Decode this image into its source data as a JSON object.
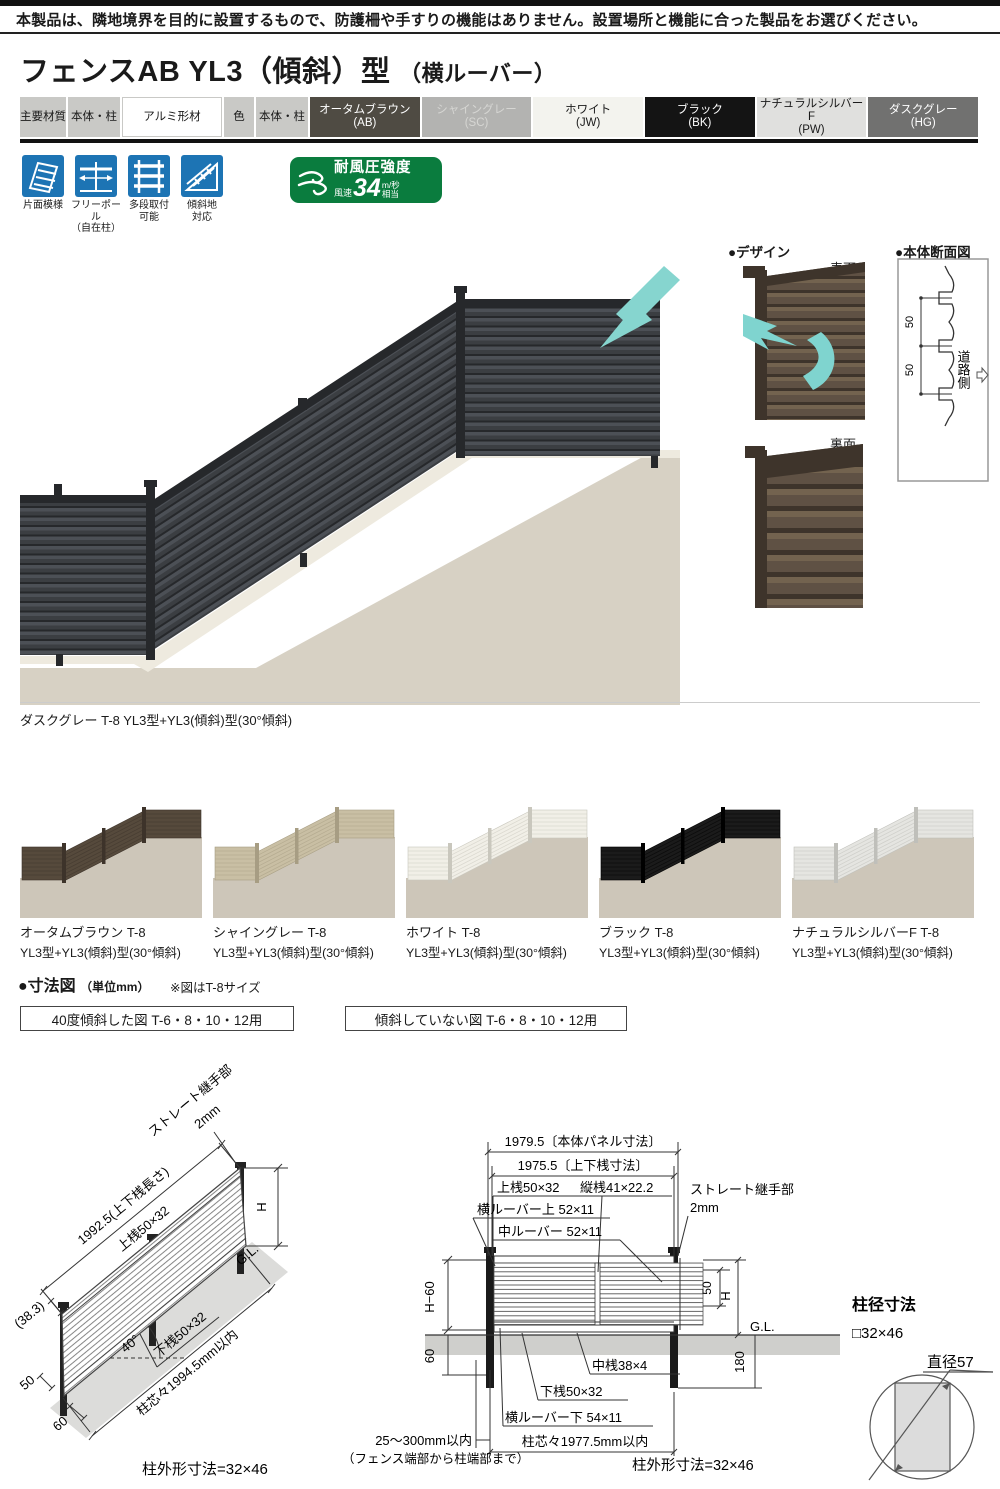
{
  "notice": "本製品は、隣地境界を目的に設置するもので、防護柵や手すりの機能はありません。設置場所と機能に合った製品をお選びください。",
  "title": {
    "main": "フェンスAB YL3（傾斜）型",
    "sub": "（横ルーバー）"
  },
  "spec": {
    "material_header": "主要材質",
    "material_scope": "本体・柱",
    "material_value": "アルミ形材",
    "color_header": "色",
    "color_scope": "本体・柱",
    "colors": [
      {
        "name": "オータムブラウン",
        "code": "(AB)",
        "bg": "#4f4b43",
        "fg": "#ffffff"
      },
      {
        "name": "シャイングレー",
        "code": "(SC)",
        "bg": "#b3b3b1",
        "fg": "#d6d6d3"
      },
      {
        "name": "ホワイト",
        "code": "(JW)",
        "bg": "#f3f3ee",
        "fg": "#1a1a1a"
      },
      {
        "name": "ブラック",
        "code": "(BK)",
        "bg": "#141414",
        "fg": "#ffffff"
      },
      {
        "name": "ナチュラルシルバーF",
        "code": "(PW)",
        "bg": "#e0e0de",
        "fg": "#1a1a1a"
      },
      {
        "name": "ダスクグレー",
        "code": "(HG)",
        "bg": "#717170",
        "fg": "#ffffff"
      }
    ]
  },
  "features": {
    "icon_bg": "#1d74b4",
    "items": [
      {
        "line1": "片面模様",
        "line2": ""
      },
      {
        "line1": "フリーポール",
        "line2": "（自在柱）"
      },
      {
        "line1": "多段取付",
        "line2": "可能"
      },
      {
        "line1": "傾斜地",
        "line2": "対応"
      }
    ],
    "wind": {
      "bg": "#0a7c3e",
      "title": "耐風圧強度",
      "prefix": "風速",
      "value": "34",
      "unit": "m/秒",
      "suffix": "相当"
    }
  },
  "photo": {
    "fence": "#3b3e42",
    "fence_dark": "#26282b",
    "fence_light": "#4c5056",
    "ground": "#d7d1c4",
    "curb": "#eeeadf",
    "arrow": "#86d5cf",
    "caption": "ダスクグレー T-8 YL3型+YL3(傾斜)型(30°傾斜)"
  },
  "design": {
    "header": "●デザイン",
    "front_label": "表面",
    "back_label": "裏面",
    "wood": "#5f5144",
    "wood_dark": "#3e342b",
    "wood_light": "#73634f",
    "teal": "#7fd4cf"
  },
  "section_view": {
    "header": "●本体断面図",
    "d50": "50",
    "road": "道路側"
  },
  "variants": [
    {
      "name": "オータムブラウン T-8",
      "desc": "YL3型+YL3(傾斜)型(30°傾斜)",
      "fence": "#564a3c",
      "fence_dark": "#3d332a"
    },
    {
      "name": "シャイングレー T-8",
      "desc": "YL3型+YL3(傾斜)型(30°傾斜)",
      "fence": "#c9bfa4",
      "fence_dark": "#a79d83"
    },
    {
      "name": "ホワイト T-8",
      "desc": "YL3型+YL3(傾斜)型(30°傾斜)",
      "fence": "#f1efe7",
      "fence_dark": "#c9c7bd"
    },
    {
      "name": "ブラック T-8",
      "desc": "YL3型+YL3(傾斜)型(30°傾斜)",
      "fence": "#1b1b1b",
      "fence_dark": "#000000"
    },
    {
      "name": "ナチュラルシルバーF T-8",
      "desc": "YL3型+YL3(傾斜)型(30°傾斜)",
      "fence": "#e5e5e1",
      "fence_dark": "#bfbfba"
    }
  ],
  "dims": {
    "header": "●寸法図",
    "unit": "（単位mm）",
    "note": "※図はT-8サイズ",
    "box1": "40度傾斜した図 T-6・8・10・12用",
    "box2": "傾斜していない図 T-6・8・10・12用",
    "left": {
      "joint": "ストレート継手部",
      "joint2": "2mm",
      "rail_len": "1992.5(上下桟長さ)",
      "top_rail": "上桟50×32",
      "offset": "(38.3)",
      "h": "H",
      "gl": "G.L.",
      "angle": "40°",
      "bottom_rail": "下桟50×32",
      "post_pitch": "柱芯々1994.5mm以内",
      "d50": "50",
      "d60": "60",
      "post_outer": "柱外形寸法=32×46"
    },
    "right": {
      "panel_w": "1979.5〔本体パネル寸法〕",
      "rail_w": "1975.5〔上下桟寸法〕",
      "top_rail": "上桟50×32",
      "v_rail": "縦桟41×22.2",
      "louver_top": "横ルーバー上 52×11",
      "louver_mid": "中ルーバー 52×11",
      "joint": "ストレート継手部",
      "joint2": "2mm",
      "h60": "H−60",
      "d50": "50",
      "h": "H",
      "gl": "G.L.",
      "d60": "60",
      "d180": "180",
      "mid_rail": "中桟38×4",
      "bottom_rail": "下桟50×32",
      "louver_bottom": "横ルーバー下 54×11",
      "end_dist": "25～300mm以内",
      "end_dist2": "（フェンス端部から柱端部まで）",
      "post_pitch": "柱芯々1977.5mm以内",
      "post_outer": "柱外形寸法=32×46"
    },
    "pole": {
      "title": "柱径寸法",
      "size": "□32×46",
      "dia": "直径57"
    }
  }
}
